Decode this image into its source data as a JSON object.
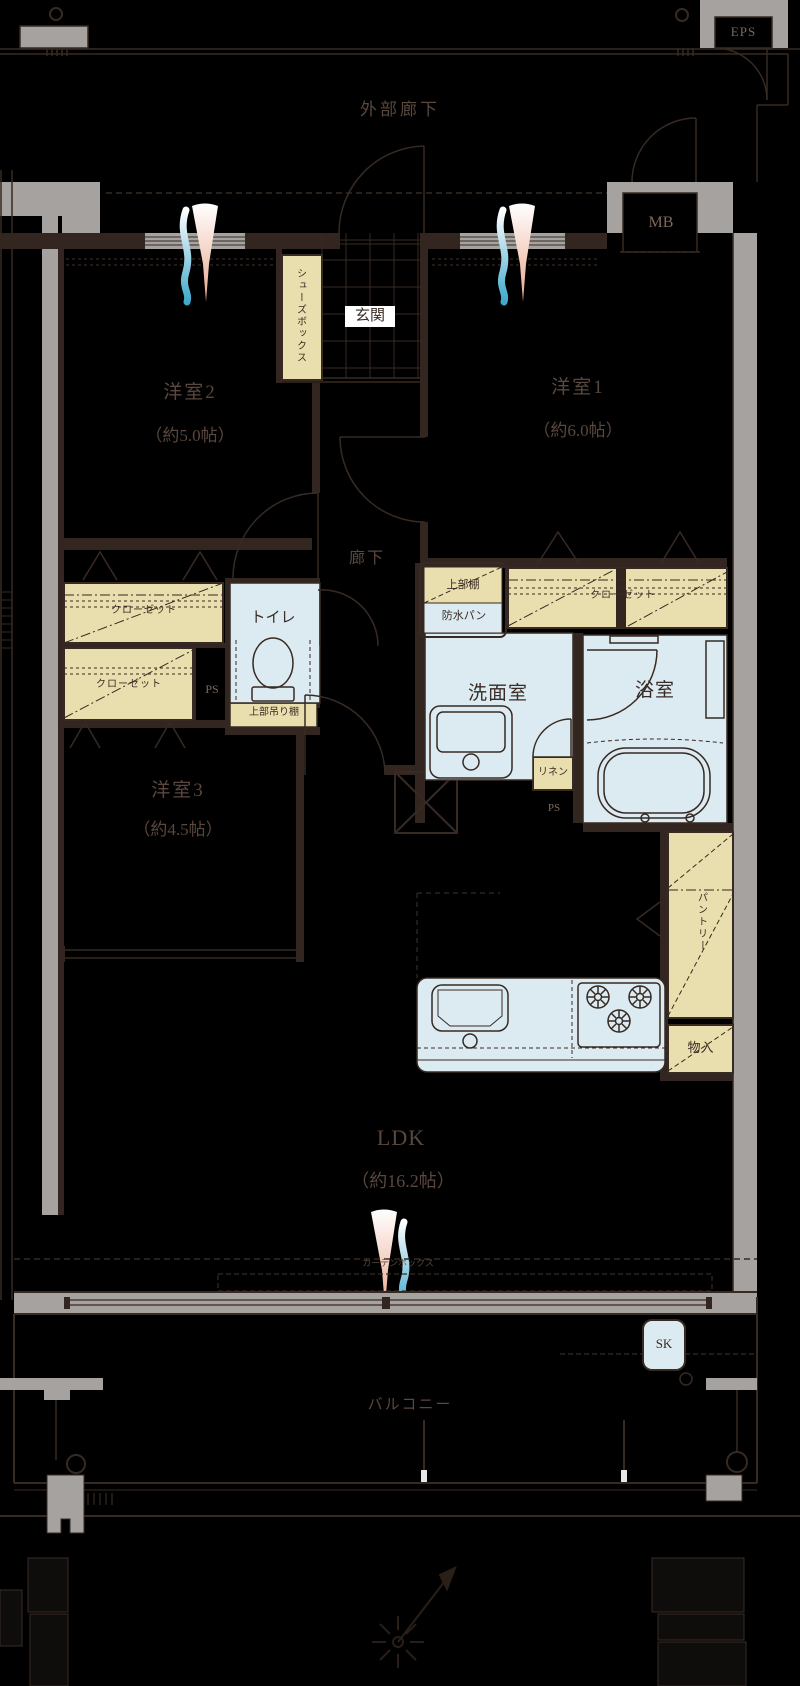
{
  "title": "apartment-floor-plan",
  "colors": {
    "background": "#000000",
    "wall_gray": "#a5a2a0",
    "wood_beige": "#e9dfae",
    "water_blue": "#dcebf1",
    "line_dark": "#372a23",
    "text_dark": "#5a473d",
    "label_bg_white": "#ffffff",
    "accent_blue": "#3fa9cc",
    "accent_peach": "#eaa78b"
  },
  "plan": {
    "corridor_label": "外部廊下",
    "eps": "EPS",
    "mb": "MB",
    "entrance": {
      "label": "玄関",
      "shoe_box": "シューズボックス"
    },
    "rooms": {
      "room1": {
        "name": "洋室1",
        "size": "（約6.0帖）"
      },
      "room2": {
        "name": "洋室2",
        "size": "（約5.0帖）"
      },
      "room3": {
        "name": "洋室3",
        "size": "（約4.5帖）"
      },
      "ldk": {
        "name": "LDK",
        "size": "（約16.2帖）"
      },
      "hallway": "廊下",
      "toilet": "トイレ",
      "washroom": "洗面室",
      "bathroom": "浴室",
      "balcony": "バルコニー"
    },
    "storage": {
      "closet_room2": "クローゼット",
      "closet_room3": "クローゼット",
      "closet_room1": "クローゼット",
      "shelf_above_toilet": "上部吊り棚",
      "upper_shelf": "上部棚",
      "linen": "リネン",
      "pantry": "パントリー",
      "storage_box": "物入"
    },
    "fixtures": {
      "waterproof_pan": "防水パン",
      "curtain_box": "カーテンボックス",
      "sk": "SK",
      "ps_left": "PS",
      "ps_right": "PS"
    }
  }
}
